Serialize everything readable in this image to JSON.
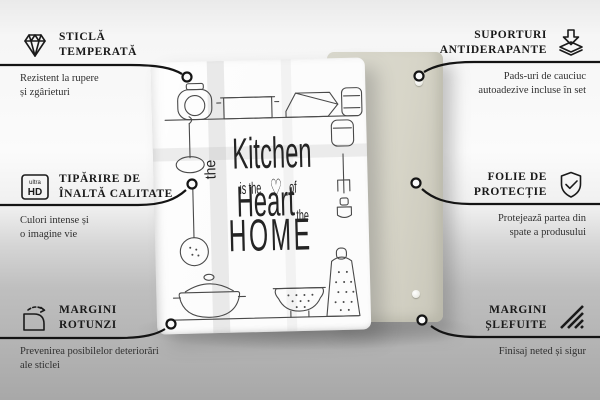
{
  "features": [
    {
      "id": "tempered-glass",
      "icon": "diamond-icon",
      "title_line1": "STICLĂ",
      "title_line2": "TEMPERATĂ",
      "desc_line1": "Rezistent la rupere",
      "desc_line2": "și zgârieturi"
    },
    {
      "id": "anti-slip-pads",
      "icon": "pads-icon",
      "title_line1": "SUPORTURI",
      "title_line2": "ANTIDERAPANTE",
      "desc_line1": "Pads-uri de cauciuc",
      "desc_line2": "autoadezive incluse în set"
    },
    {
      "id": "hd-print",
      "icon": "ultra-hd-icon",
      "title_line1": "TIPĂRIRE DE",
      "title_line2": "ÎNALTĂ CALITATE",
      "desc_line1": "Culori intense și",
      "desc_line2": "o imagine vie"
    },
    {
      "id": "protective-film",
      "icon": "shield-check-icon",
      "title_line1": "FOLIE DE",
      "title_line2": "PROTECȚIE",
      "desc_line1": "Protejează partea din",
      "desc_line2": "spate a produsului"
    },
    {
      "id": "rounded-corners",
      "icon": "rounded-corner-icon",
      "title_line1": "MARGINI",
      "title_line2": "ROTUNZI",
      "desc_line1": "Prevenirea posibilelor deteriorări",
      "desc_line2": "ale sticlei"
    },
    {
      "id": "polished-edges",
      "icon": "polished-edge-icon",
      "title_line1": "MARGINI",
      "title_line2": "ȘLEFUITE",
      "desc_line1": "Finisaj neted și sigur",
      "desc_line2": ""
    }
  ],
  "icon_labels": {
    "ultra": "ultra",
    "hd": "HD"
  },
  "board_print": {
    "the_vertical": "the",
    "kitchen": "Kitchen",
    "is_the": "is the",
    "heart_glyph": "♡",
    "of": "of",
    "heart": "Heart",
    "the_small": "the",
    "home": "HOME"
  },
  "colors": {
    "callout_line": "#141414",
    "back_panel": "#d7d5c8",
    "front_board": "#fcfcfc",
    "floor": "#a8a8a8"
  }
}
